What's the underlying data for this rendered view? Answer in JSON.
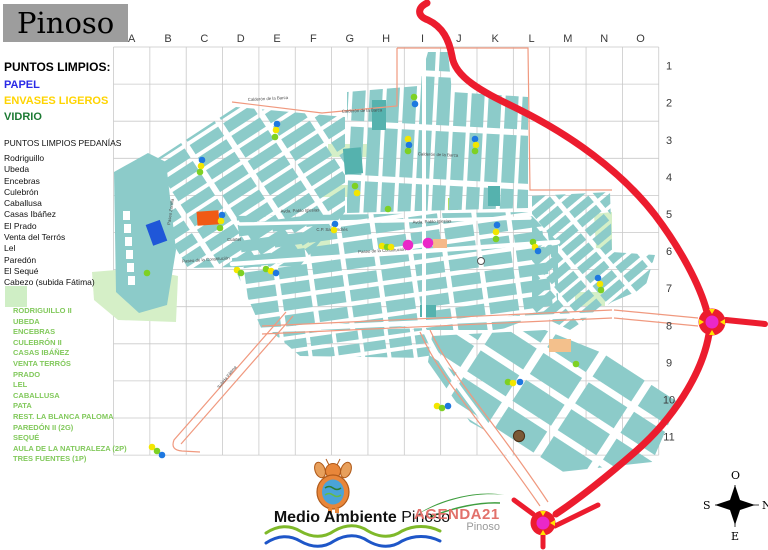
{
  "title": "Pinoso",
  "legend": {
    "heading": "PUNTOS LIMPIOS:",
    "items": [
      {
        "id": "papel",
        "label": "PAPEL",
        "color": "#2a2ae6"
      },
      {
        "id": "envases",
        "label": "ENVASES LIGEROS",
        "color": "#ffd400"
      },
      {
        "id": "vidrio",
        "label": "VIDRIO",
        "color": "#1c7a33"
      }
    ]
  },
  "pedanias": {
    "heading": "PUNTOS LIMPIOS PEDANÍAS",
    "items": [
      "Rodriguillo",
      "Ubeda",
      "Encebras",
      "Culebrón",
      "Caballusa",
      "Casas Ibáñez",
      "El Prado",
      "Venta del Terrós",
      "Lel",
      "Paredón",
      "El Sequé",
      "Cabezo (subida Fátima)"
    ]
  },
  "pedanias_green": {
    "swatch_color": "#cfeec5",
    "text_color": "#82c95c",
    "items": [
      "RODRIGUILLO II",
      "UBEDA",
      "ENCEBRAS",
      "CULEBRÓN II",
      "CASAS IBÁÑEZ",
      "VENTA TERRÓS",
      "PRADO",
      "LEL",
      "CABALLUSA",
      "PATA",
      "REST. LA BLANCA PALOMA",
      "PAREDÓN II (2G)",
      "SEQUÉ",
      "AULA DE LA NATURALEZA (2P)",
      "TRES FUENTES (1P)"
    ]
  },
  "grid": {
    "columns": [
      "A",
      "B",
      "C",
      "D",
      "E",
      "F",
      "G",
      "H",
      "I",
      "J",
      "K",
      "L",
      "M",
      "N",
      "O"
    ],
    "rows": [
      "1",
      "2",
      "3",
      "4",
      "5",
      "6",
      "7",
      "8",
      "9",
      "10",
      "11"
    ]
  },
  "map": {
    "dot_colors": {
      "papel": "#1e78e0",
      "envases": "#f3e600",
      "vidrio": "#7ed123"
    },
    "special_colors": {
      "magenta": "#ea28c8",
      "brown": "#7b5a36"
    },
    "street_labels": [
      {
        "text": "Calderón de la Barca",
        "x": 268,
        "y": 100,
        "rot": -3
      },
      {
        "text": "Calderón de la Barca",
        "x": 362,
        "y": 112,
        "rot": -2
      },
      {
        "text": "Calderón de la Barca",
        "x": 438,
        "y": 156,
        "rot": 2
      },
      {
        "text": "Paseo Zorrilla",
        "x": 172,
        "y": 212,
        "rot": -82
      },
      {
        "text": "Avda. Pablo Iglesias",
        "x": 300,
        "y": 212,
        "rot": -2
      },
      {
        "text": "Avda. Pablo Iglesias",
        "x": 432,
        "y": 223,
        "rot": -2
      },
      {
        "text": "C.P. San Andrés",
        "x": 332,
        "y": 231,
        "rot": 0
      },
      {
        "text": "Cuartel",
        "x": 234,
        "y": 241,
        "rot": 0
      },
      {
        "text": "Paseo de la Constitución",
        "x": 206,
        "y": 261,
        "rot": -4
      },
      {
        "text": "Paseo de la Constitución",
        "x": 382,
        "y": 252,
        "rot": -3
      },
      {
        "text": "Subida Fátima",
        "x": 228,
        "y": 378,
        "rot": -51
      }
    ],
    "points": [
      {
        "x": 202,
        "y": 160,
        "type": "papel"
      },
      {
        "x": 201,
        "y": 166,
        "type": "envases"
      },
      {
        "x": 200,
        "y": 172,
        "type": "vidrio"
      },
      {
        "x": 277,
        "y": 124,
        "type": "papel"
      },
      {
        "x": 276,
        "y": 130,
        "type": "envases"
      },
      {
        "x": 275,
        "y": 137,
        "type": "vidrio"
      },
      {
        "x": 414,
        "y": 97,
        "type": "vidrio"
      },
      {
        "x": 415,
        "y": 104,
        "type": "papel"
      },
      {
        "x": 408,
        "y": 139,
        "type": "envases"
      },
      {
        "x": 409,
        "y": 145,
        "type": "papel"
      },
      {
        "x": 408,
        "y": 151,
        "type": "vidrio"
      },
      {
        "x": 475,
        "y": 139,
        "type": "papel"
      },
      {
        "x": 476,
        "y": 145,
        "type": "envases"
      },
      {
        "x": 475,
        "y": 151,
        "type": "vidrio"
      },
      {
        "x": 355,
        "y": 186,
        "type": "vidrio"
      },
      {
        "x": 357,
        "y": 193,
        "type": "envases"
      },
      {
        "x": 388,
        "y": 209,
        "type": "vidrio"
      },
      {
        "x": 222,
        "y": 215,
        "type": "papel"
      },
      {
        "x": 221,
        "y": 221,
        "type": "envases"
      },
      {
        "x": 220,
        "y": 228,
        "type": "vidrio"
      },
      {
        "x": 335,
        "y": 224,
        "type": "papel"
      },
      {
        "x": 334,
        "y": 230,
        "type": "envases"
      },
      {
        "x": 266,
        "y": 269,
        "type": "vidrio"
      },
      {
        "x": 271,
        "y": 271,
        "type": "envases"
      },
      {
        "x": 276,
        "y": 273,
        "type": "papel"
      },
      {
        "x": 237,
        "y": 270,
        "type": "envases"
      },
      {
        "x": 241,
        "y": 273,
        "type": "vidrio"
      },
      {
        "x": 147,
        "y": 273,
        "type": "vidrio"
      },
      {
        "x": 382,
        "y": 246,
        "type": "envases"
      },
      {
        "x": 387,
        "y": 247,
        "type": "vidrio"
      },
      {
        "x": 391,
        "y": 247,
        "type": "envases"
      },
      {
        "x": 497,
        "y": 225,
        "type": "papel"
      },
      {
        "x": 496,
        "y": 232,
        "type": "envases"
      },
      {
        "x": 496,
        "y": 239,
        "type": "vidrio"
      },
      {
        "x": 533,
        "y": 242,
        "type": "vidrio"
      },
      {
        "x": 535,
        "y": 247,
        "type": "envases"
      },
      {
        "x": 538,
        "y": 251,
        "type": "papel"
      },
      {
        "x": 598,
        "y": 278,
        "type": "papel"
      },
      {
        "x": 600,
        "y": 284,
        "type": "envases"
      },
      {
        "x": 601,
        "y": 290,
        "type": "vidrio"
      },
      {
        "x": 437,
        "y": 406,
        "type": "envases"
      },
      {
        "x": 442,
        "y": 408,
        "type": "vidrio"
      },
      {
        "x": 448,
        "y": 406,
        "type": "papel"
      },
      {
        "x": 508,
        "y": 382,
        "type": "vidrio"
      },
      {
        "x": 513,
        "y": 383,
        "type": "envases"
      },
      {
        "x": 520,
        "y": 382,
        "type": "papel"
      },
      {
        "x": 576,
        "y": 364,
        "type": "vidrio"
      },
      {
        "x": 152,
        "y": 447,
        "type": "envases"
      },
      {
        "x": 157,
        "y": 451,
        "type": "vidrio"
      },
      {
        "x": 162,
        "y": 455,
        "type": "papel"
      }
    ],
    "special_points": [
      {
        "x": 408,
        "y": 245,
        "type": "magenta"
      },
      {
        "x": 428,
        "y": 243,
        "type": "magenta"
      },
      {
        "x": 519,
        "y": 436,
        "type": "brown"
      }
    ]
  },
  "footer": {
    "brand_bold": "Medio Ambiente",
    "brand_regular": " Pinoso",
    "agenda_title": "AGENDA21",
    "agenda_subtitle": "Pinoso"
  },
  "compass": {
    "top": "O",
    "right": "N",
    "bottom": "E",
    "left": "S"
  }
}
